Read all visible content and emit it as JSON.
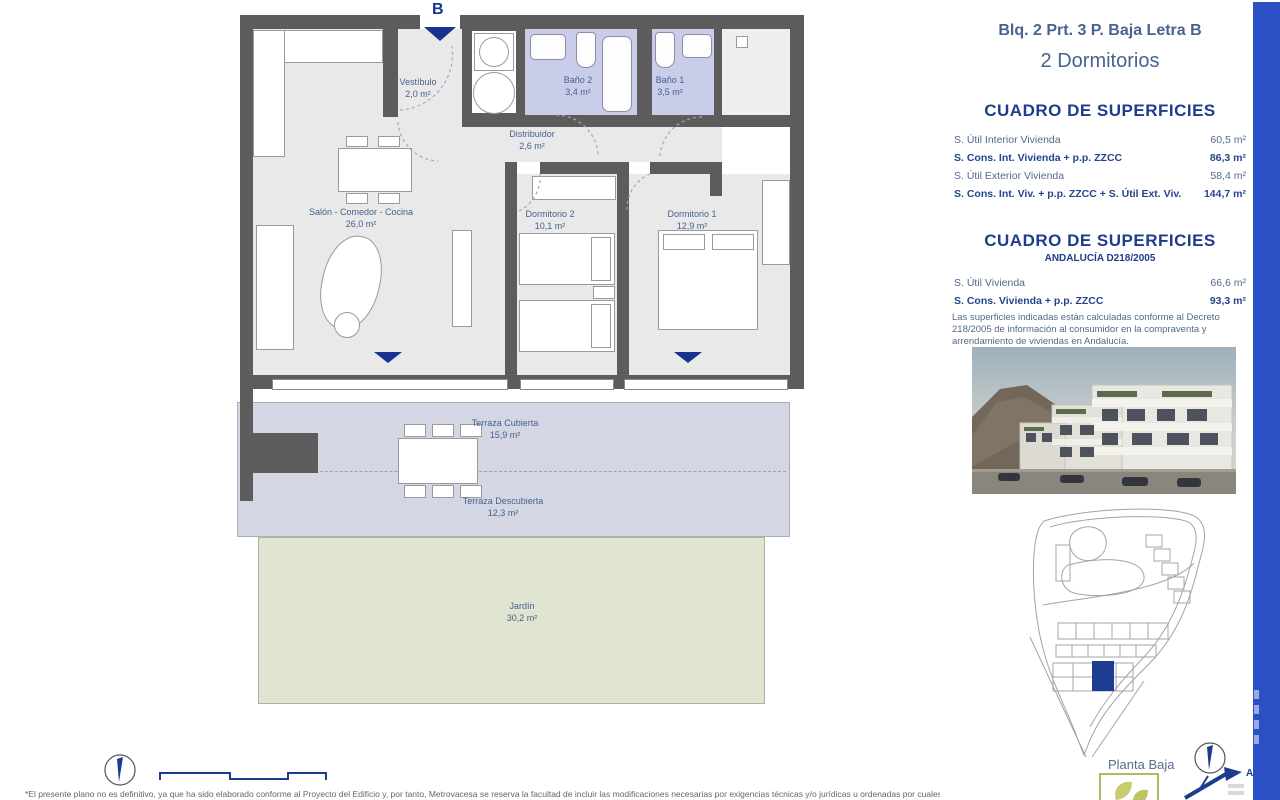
{
  "header": {
    "line1": "Blq. 2 Prt. 3 P. Baja Letra B",
    "line2": "2 Dormitorios"
  },
  "tables": [
    {
      "title": "CUADRO DE SUPERFICIES",
      "rows": [
        {
          "label": "S. Útil Interior Vivienda",
          "value": "60,5 m²"
        },
        {
          "label": "S. Cons. Int. Vivienda + p.p. ZZCC",
          "value": "86,3 m²"
        },
        {
          "label": "S. Útil Exterior Vivienda",
          "value": "58,4 m²"
        },
        {
          "label": "S. Cons. Int. Viv. + p.p. ZZCC + S. Útil Ext. Viv.",
          "value": "144,7 m²"
        }
      ]
    },
    {
      "title": "CUADRO DE SUPERFICIES",
      "subtitle": "ANDALUCÍA D218/2005",
      "rows": [
        {
          "label": "S. Útil Vivienda",
          "value": "66,6 m²"
        },
        {
          "label": "S. Cons. Vivienda + p.p. ZZCC",
          "value": "93,3 m²"
        }
      ],
      "note": "Las superficies indicadas están calculadas conforme al Decreto 218/2005 de información al consumidor en la compraventa y arrendamiento de viviendas en Andalucía."
    }
  ],
  "plan": {
    "entrance_label": "B",
    "rooms": [
      {
        "name": "Vestíbulo",
        "area": "2,0 m²"
      },
      {
        "name": "Baño 2",
        "area": "3,4 m²"
      },
      {
        "name": "Baño 1",
        "area": "3,5 m²"
      },
      {
        "name": "Distribuidor",
        "area": "2,6 m²"
      },
      {
        "name": "Salón - Comedor - Cocina",
        "area": "26,0 m²"
      },
      {
        "name": "Dormitorio 2",
        "area": "10,1 m²"
      },
      {
        "name": "Dormitorio 1",
        "area": "12,9 m²"
      },
      {
        "name": "Terraza Cubierta",
        "area": "15,9 m²"
      },
      {
        "name": "Terraza Descubierta",
        "area": "12,3 m²"
      },
      {
        "name": "Jardín",
        "area": "30,2 m²"
      }
    ]
  },
  "sideplan": {
    "caption": "Planta Baja",
    "marker": "A"
  },
  "footer": {
    "disclaimer": "*El presente plano no es definitivo, ya que ha sido elaborado conforme al Proyecto del Edificio y, por tanto, Metrovacesa se reserva la facultad de incluir las modificaciones necesarias por exigencias técnicas y/o jurídicas u ordenadas por cualesquiera administraciones y"
  },
  "colors": {
    "wall": "#5c5c5c",
    "room": "#e9e9e9",
    "bath": "#cacdea",
    "terrace": "#d4d7e3",
    "garden": "#dfe5d1",
    "accent_navy": "#16338f",
    "bar_blue": "#2b4fc4",
    "text_blue": "#47618d"
  }
}
